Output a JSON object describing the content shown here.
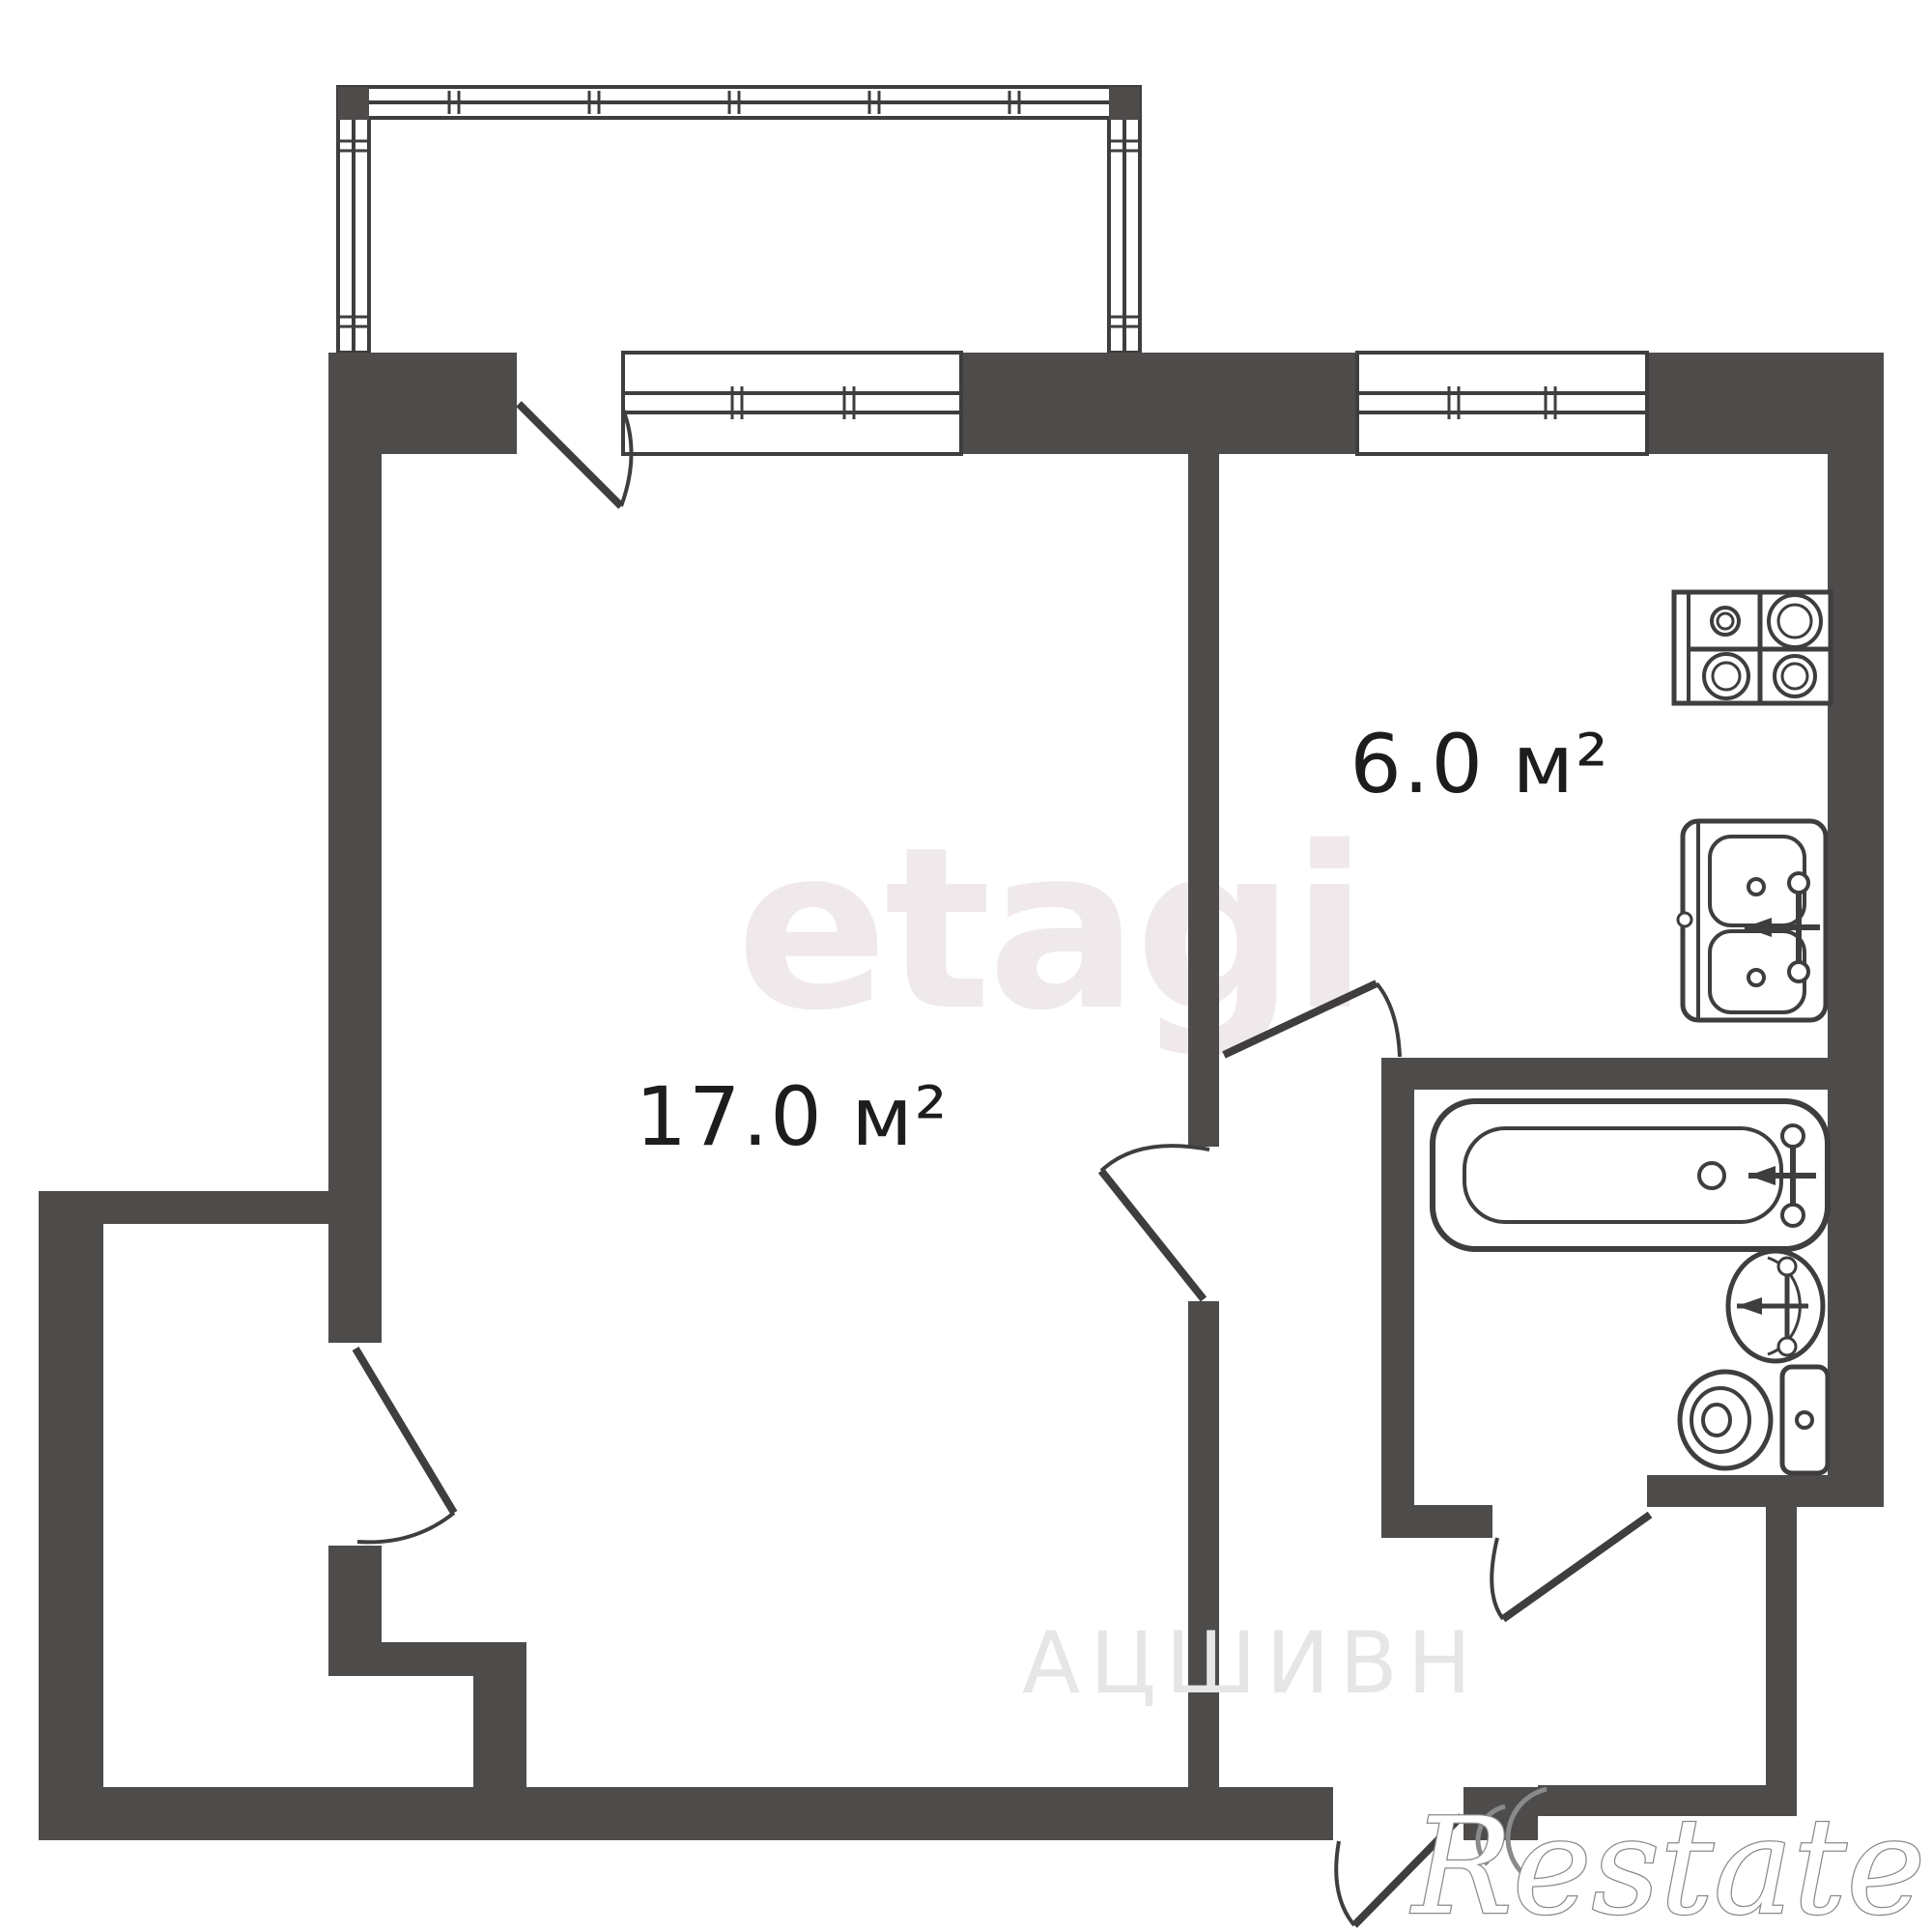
{
  "page": {
    "type": "apartment-floor-plan"
  },
  "rooms": [
    {
      "id": "living-room",
      "area_label": "17.0 м²"
    },
    {
      "id": "kitchen",
      "area_label": "6.0 м²"
    }
  ],
  "fixtures": [
    {
      "icon": "stove-icon",
      "room": "kitchen"
    },
    {
      "icon": "sink-icon",
      "room": "kitchen"
    },
    {
      "icon": "bathtub-icon",
      "room": "bathroom"
    },
    {
      "icon": "washbasin-icon",
      "room": "bathroom"
    },
    {
      "icon": "toilet-icon",
      "room": "bathroom"
    }
  ],
  "watermarks": {
    "center": "etagi",
    "faint_bottom": "АЦШИВН",
    "brand": "Restate"
  },
  "colors": {
    "wall": "#4e4b4b",
    "line": "#3f3d3d",
    "background": "#ffffff",
    "label_text": "#1d1d1d",
    "watermark_center": "#efe9ec",
    "watermark_faint": "#e7e6e6",
    "brand_fill": "#ffffff",
    "brand_outline": "#8a8a8a"
  }
}
